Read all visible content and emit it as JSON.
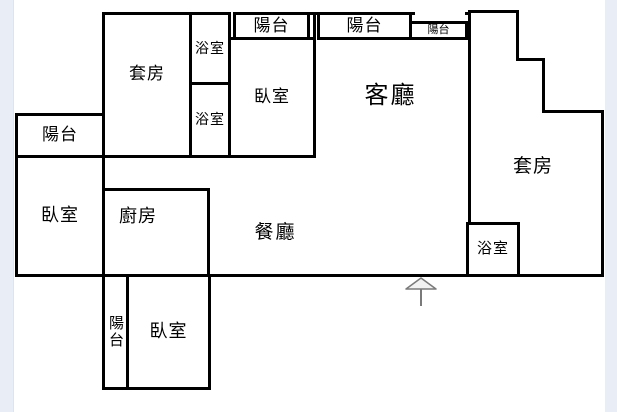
{
  "plan_title": "apartment-floor-plan",
  "colors": {
    "wall": "#000000",
    "canvas": "#ffffff",
    "page_margin": "#e8edf6",
    "arrow": "#7a7a7a"
  },
  "rooms": {
    "suite_top_left": {
      "label": "套房"
    },
    "bathroom_upper": {
      "label": "浴室"
    },
    "bathroom_lower": {
      "label": "浴室"
    },
    "balcony_top_1": {
      "label": "陽台"
    },
    "bedroom_top": {
      "label": "臥室"
    },
    "living_room": {
      "label": "客廳"
    },
    "balcony_top_2": {
      "label": "陽台"
    },
    "balcony_top_small": {
      "label": "陽台"
    },
    "suite_right": {
      "label": "套房"
    },
    "bathroom_right": {
      "label": "浴室"
    },
    "balcony_left": {
      "label": "陽台"
    },
    "bedroom_left": {
      "label": "臥室"
    },
    "kitchen": {
      "label": "廚房"
    },
    "dining_room": {
      "label": "餐廳"
    },
    "balcony_bottom": {
      "label": "陽台"
    },
    "bedroom_bottom": {
      "label": "臥室"
    }
  },
  "icons": {
    "entrance": "up-arrow-icon"
  }
}
